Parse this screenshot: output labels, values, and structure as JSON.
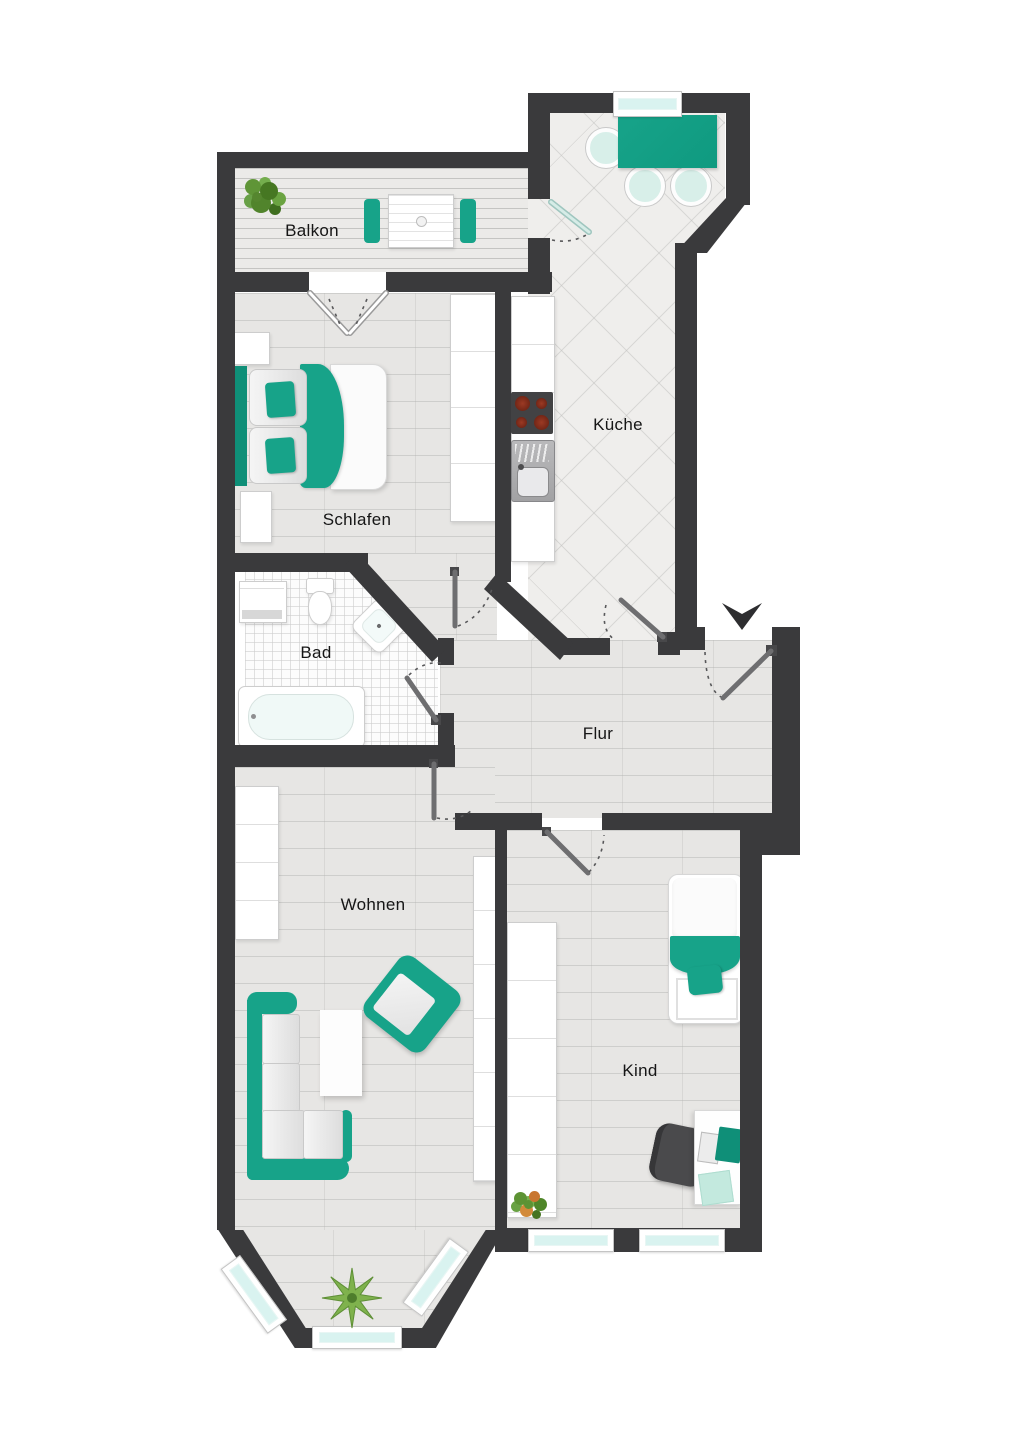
{
  "plan": {
    "type": "apartment-floor-plan",
    "rooms": {
      "balkon": {
        "label": "Balkon"
      },
      "schlafen": {
        "label": "Schlafen"
      },
      "kueche": {
        "label": "Küche"
      },
      "bad": {
        "label": "Bad"
      },
      "flur": {
        "label": "Flur"
      },
      "wohnen": {
        "label": "Wohnen"
      },
      "kind": {
        "label": "Kind"
      }
    },
    "colors": {
      "wall": "#3a3a3c",
      "accent": "#17a389",
      "accent_dark": "#0f8f78",
      "glass": "#d9f3f0",
      "door": "#6e6e70"
    }
  }
}
